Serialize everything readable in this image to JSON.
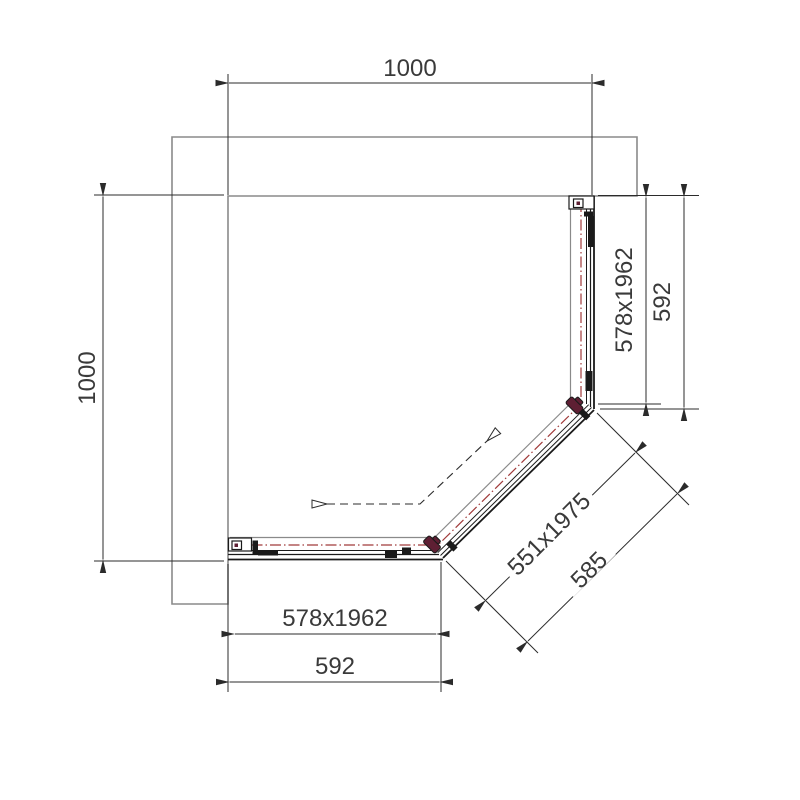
{
  "drawing": {
    "kind": "pentagonal corner shower enclosure - plan view technical drawing"
  },
  "dimensions": {
    "top_width": {
      "label": "1000"
    },
    "left_height": {
      "label": "1000"
    },
    "right_panel_glass": {
      "label": "578x1962"
    },
    "right_panel_overall": {
      "label": "592"
    },
    "door_glass": {
      "label": "551x1975"
    },
    "door_overall": {
      "label": "585"
    },
    "bottom_panel_glass": {
      "label": "578x1962"
    },
    "bottom_panel_overall": {
      "label": "592"
    }
  },
  "colors": {
    "background": "#ffffff",
    "line": "#1a1a1a",
    "wall": "#8a8a8a",
    "dim": "#2b2b2b",
    "text": "#3a3a3a",
    "glass-axis": "#a03a3a",
    "hinge": "#5e1f33"
  }
}
